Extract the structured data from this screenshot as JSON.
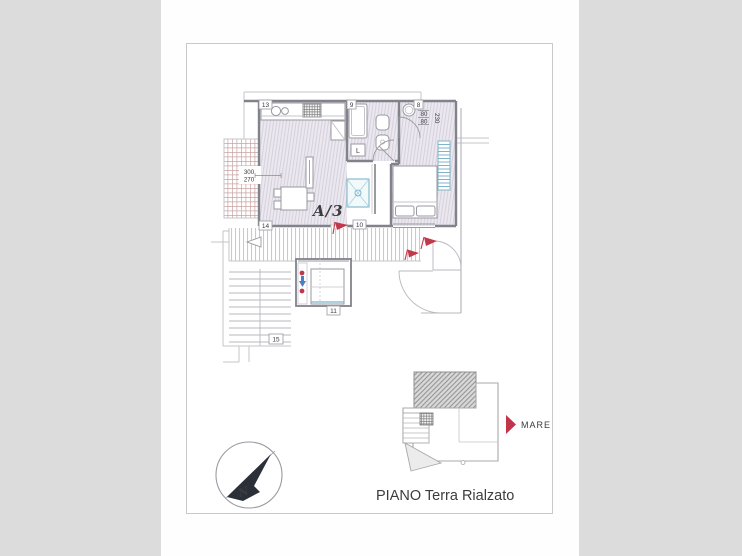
{
  "title": "PIANO Terra Rialzato",
  "plan": {
    "unit_label": "A/3",
    "letter_label": "L",
    "room_numbers": {
      "n13": "13",
      "n9": "9",
      "n8": "8",
      "n14": "14",
      "n10": "10",
      "n11": "11",
      "n15": "15"
    },
    "dimensions": {
      "left_top": "300",
      "left_bottom": "270",
      "right_80a": "80",
      "right_80b": "80",
      "right_230": "230"
    }
  },
  "keymap": {
    "sea_label": "MARE"
  },
  "compass": {
    "north_label": "N"
  },
  "colors": {
    "accent_red": "#c0394b",
    "radiator_teal": "#7fb5c9",
    "room_fill": "#ebe8ef",
    "needle_dark": "#2b3038"
  }
}
